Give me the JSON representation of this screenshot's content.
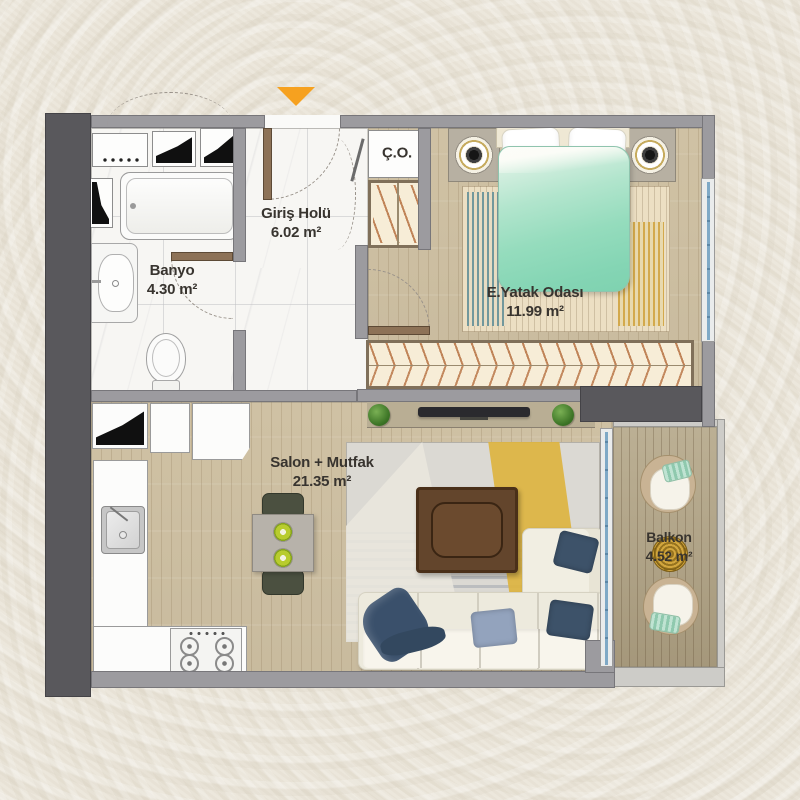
{
  "plan_type": "apartment-floor-plan",
  "rooms": {
    "giris": {
      "name": "Giriş Holü",
      "area": "6.02 m²"
    },
    "banyo": {
      "name": "Banyo",
      "area": "4.30 m²"
    },
    "co": {
      "name": "Ç.O."
    },
    "yatak": {
      "name": "E.Yatak Odası",
      "area": "11.99 m²"
    },
    "salon": {
      "name": "Salon + Mutfak",
      "area": "21.35 m²"
    },
    "balkon": {
      "name": "Balkon",
      "area": "4.52 m²"
    }
  },
  "symbols": {
    "entrance_arrow": "▼"
  },
  "palette": {
    "paper": "#ebe6da",
    "wall_gray": "#9c9b9f",
    "shaft_dark": "#59585c",
    "wood_floor": "#d5c8ab",
    "balcony_deck": "#b6a98b",
    "marble_floor": "#f7f6f3",
    "accent_orange": "#f6a11f",
    "bed_mint": "#7fd2b0",
    "rug_teal": "#72989c",
    "rug_yellow": "#ddb440",
    "pillow_navy": "#3d5269",
    "door_brown": "#8d7257",
    "label_text": "#38342f"
  }
}
